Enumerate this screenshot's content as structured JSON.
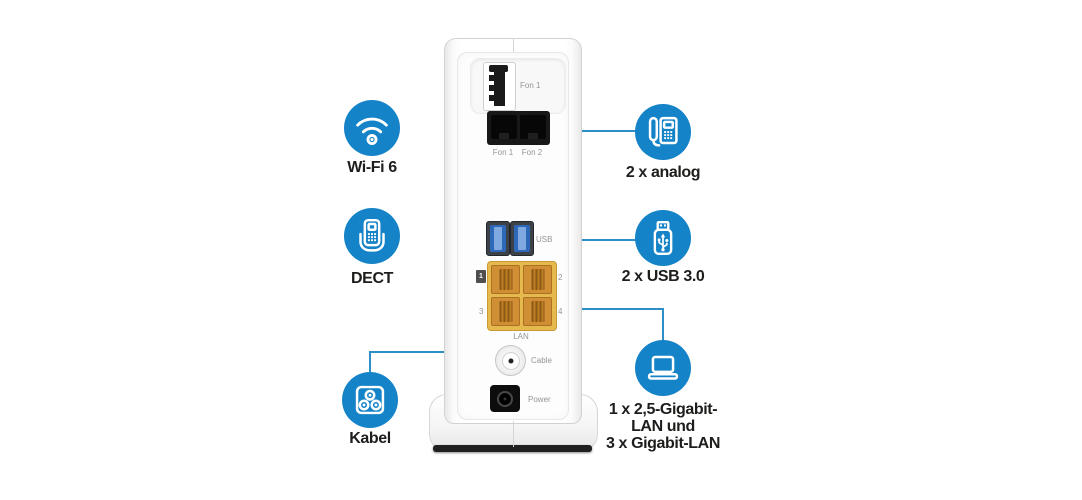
{
  "features": {
    "left": [
      {
        "name": "wifi6",
        "label": "Wi-Fi 6",
        "icon": "wifi-icon"
      },
      {
        "name": "dect",
        "label": "DECT",
        "icon": "dect-phone-icon"
      },
      {
        "name": "kabel",
        "label": "Kabel",
        "icon": "cable-socket-icon"
      }
    ],
    "right": [
      {
        "name": "analog",
        "label": "2 x analog",
        "icon": "desk-phone-icon"
      },
      {
        "name": "usb30",
        "label": "2 x USB 3.0",
        "icon": "usb-stick-icon"
      },
      {
        "name": "gigabit_lan",
        "icon": "laptop-icon",
        "label_lines": [
          "1 x 2,5-Gigabit-",
          "LAN und",
          "3 x Gigabit-LAN"
        ]
      }
    ]
  },
  "router": {
    "ports": {
      "tae_label": "Fon 1",
      "rj11_label_1": "Fon 1",
      "rj11_label_2": "Fon 2",
      "usb_label": "USB",
      "lan_port_1": "1",
      "lan_port_2": "2",
      "lan_port_3": "3",
      "lan_port_4": "4",
      "lan_label": "LAN",
      "cable_label": "Cable",
      "power_label": "Power"
    }
  },
  "colors": {
    "accent_blue": "#1583c7",
    "line_blue": "#2e8fc6",
    "lan_orange": "#d18f35",
    "lan_frame_yellow": "#e5b94e",
    "usb_port_blue": "#2e68b8",
    "label_text": "#1d1d1b",
    "port_label_gray": "#949494"
  }
}
